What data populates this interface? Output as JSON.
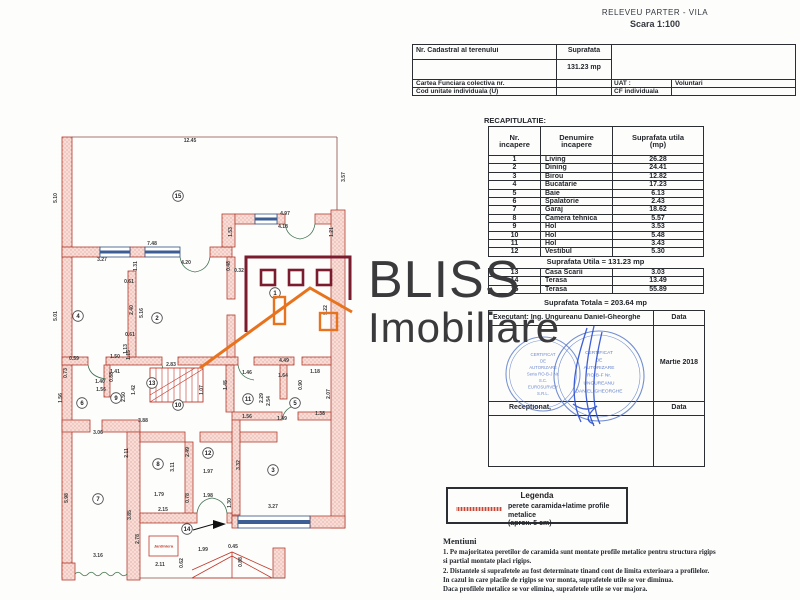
{
  "document": {
    "title": "RELEVEU PARTER - VILA",
    "scale": "Scara 1:100"
  },
  "cadastral": {
    "nr_cadastral_label": "Nr. Cadastral al terenului",
    "suprafata_label": "Suprafata",
    "suprafata_value": "131.23 mp",
    "carte_funciara_label": "Cartea Funciara colectiva nr.",
    "uat_label": "UAT :",
    "uat_value": "Voluntari",
    "cod_unitate_label": "Cod unitate individuala (U)",
    "cf_label": "CF individuala"
  },
  "recap": {
    "title": "RECAPITULATIE:",
    "headers": [
      "Nr.\nincapere",
      "Denumire\nincapere",
      "Suprafata utila\n(mp)"
    ],
    "rows": [
      [
        "1",
        "Living",
        "26.28"
      ],
      [
        "2",
        "Dining",
        "24.41"
      ],
      [
        "3",
        "Birou",
        "12.82"
      ],
      [
        "4",
        "Bucatarie",
        "17.23"
      ],
      [
        "5",
        "Baie",
        "6.13"
      ],
      [
        "6",
        "Spalatorie",
        "2.43"
      ],
      [
        "7",
        "Garaj",
        "18.62"
      ],
      [
        "8",
        "Camera tehnica",
        "5.57"
      ],
      [
        "9",
        "Hol",
        "3.53"
      ],
      [
        "10",
        "Hol",
        "5.48"
      ],
      [
        "11",
        "Hol",
        "3.43"
      ],
      [
        "12",
        "Vestibul",
        "5.30"
      ]
    ],
    "utila_line": "Suprafata Utila =  131.23 mp",
    "extra_rows": [
      [
        "13",
        "Casa Scarii",
        "3.03"
      ],
      [
        "14",
        "Terasa",
        "13.49"
      ],
      [
        "15",
        "Terasa",
        "55.89"
      ]
    ],
    "totala_line": "Suprafata Totala = 203.64 mp"
  },
  "execution": {
    "executant_label": "Executant: Ing. Ungureanu Daniel-Gheorghe",
    "data_label": "Data",
    "data_value": "Martie 2018",
    "receptionat_label": "Receptionat,",
    "data_label2": "Data",
    "stamp1": [
      "CERTIFICAT",
      "DE",
      "AUTORIZARE",
      "Seria RO-B-J Nr.",
      "S.C.",
      "EUROSURVEY",
      "S.R.L."
    ],
    "stamp2": [
      "CERTIFICAT",
      "DE",
      "AUTORIZARE",
      "RO-B-F Nr.",
      "UNGUREANU",
      "DANIEL-GHEORGHE"
    ]
  },
  "legend": {
    "title": "Legenda",
    "line1": "perete caramida+latime profile metalice",
    "line2": "(aprox. 5 cm)"
  },
  "mentiuni": {
    "title": "Mentiuni",
    "lines": [
      "1. Pe majoritatea peretilor de caramida sunt montate profile metalice pentru structura rigips",
      "si partial montate placi rigips.",
      "2. Distantele si suprafetele au fost determinate tinand cont de limita exterioara a profilelor.",
      "In cazul in care placile de rigips se vor monta, suprafetele utile se vor diminua.",
      "Daca profilele metalice se vor elimina, suprafetele utile se vor majora."
    ]
  },
  "watermark": {
    "line1": "BLISS",
    "line2": "Imobiliare"
  },
  "plan": {
    "jardiniera_label": "Jardiniera",
    "rooms": [
      {
        "n": "1",
        "x": 235,
        "y": 178
      },
      {
        "n": "2",
        "x": 117,
        "y": 203
      },
      {
        "n": "3",
        "x": 233,
        "y": 355
      },
      {
        "n": "4",
        "x": 38,
        "y": 201
      },
      {
        "n": "5",
        "x": 255,
        "y": 288
      },
      {
        "n": "6",
        "x": 42,
        "y": 288
      },
      {
        "n": "7",
        "x": 58,
        "y": 384
      },
      {
        "n": "8",
        "x": 118,
        "y": 349
      },
      {
        "n": "9",
        "x": 76,
        "y": 283
      },
      {
        "n": "10",
        "x": 138,
        "y": 290
      },
      {
        "n": "11",
        "x": 208,
        "y": 284
      },
      {
        "n": "12",
        "x": 168,
        "y": 338
      },
      {
        "n": "13",
        "x": 112,
        "y": 268
      },
      {
        "n": "14",
        "x": 147,
        "y": 414
      },
      {
        "n": "15",
        "x": 138,
        "y": 81
      }
    ],
    "dimensions": [
      {
        "t": "12.45",
        "x": 150,
        "y": 27,
        "r": 0
      },
      {
        "t": "5.10",
        "x": 17,
        "y": 83,
        "r": 1
      },
      {
        "t": "3.57",
        "x": 305,
        "y": 62,
        "r": 1
      },
      {
        "t": "4.97",
        "x": 245,
        "y": 100,
        "r": 0
      },
      {
        "t": "4.18",
        "x": 243,
        "y": 113,
        "r": 0
      },
      {
        "t": "1.53",
        "x": 192,
        "y": 117,
        "r": 1
      },
      {
        "t": "1.21",
        "x": 293,
        "y": 117,
        "r": 1
      },
      {
        "t": "7.48",
        "x": 112,
        "y": 130,
        "r": 0
      },
      {
        "t": "3.27",
        "x": 62,
        "y": 146,
        "r": 0
      },
      {
        "t": "4.20",
        "x": 146,
        "y": 149,
        "r": 0
      },
      {
        "t": "0.48",
        "x": 190,
        "y": 151,
        "r": 1
      },
      {
        "t": "0.32",
        "x": 199,
        "y": 157,
        "r": 0
      },
      {
        "t": "5.01",
        "x": 17,
        "y": 201,
        "r": 1
      },
      {
        "t": "0.61",
        "x": 89,
        "y": 168,
        "r": 0
      },
      {
        "t": "2.40",
        "x": 93,
        "y": 195,
        "r": 1
      },
      {
        "t": "5.16",
        "x": 103,
        "y": 198,
        "r": 1
      },
      {
        "t": "1.31",
        "x": 97,
        "y": 151,
        "r": 1
      },
      {
        "t": "5.22",
        "x": 287,
        "y": 195,
        "r": 1
      },
      {
        "t": "0.61",
        "x": 90,
        "y": 221,
        "r": 0
      },
      {
        "t": "1.13",
        "x": 87,
        "y": 234,
        "r": 1
      },
      {
        "t": "0.59",
        "x": 34,
        "y": 245,
        "r": 0
      },
      {
        "t": "0.73",
        "x": 27,
        "y": 258,
        "r": 1
      },
      {
        "t": "1.50",
        "x": 75,
        "y": 243,
        "r": 0
      },
      {
        "t": "1.41",
        "x": 75,
        "y": 258,
        "r": 0
      },
      {
        "t": "1.15",
        "x": 90,
        "y": 240,
        "r": 1
      },
      {
        "t": "1.40",
        "x": 60,
        "y": 268,
        "r": 0
      },
      {
        "t": "1.56",
        "x": 61,
        "y": 276,
        "r": 0
      },
      {
        "t": "0.88",
        "x": 73,
        "y": 262,
        "r": 1
      },
      {
        "t": "2.50",
        "x": 85,
        "y": 282,
        "r": 1
      },
      {
        "t": "1.42",
        "x": 95,
        "y": 275,
        "r": 1
      },
      {
        "t": "2.83",
        "x": 131,
        "y": 251,
        "r": 0
      },
      {
        "t": "1.07",
        "x": 163,
        "y": 275,
        "r": 1
      },
      {
        "t": "1.45",
        "x": 187,
        "y": 270,
        "r": 1
      },
      {
        "t": "1.46",
        "x": 207,
        "y": 259,
        "r": 0
      },
      {
        "t": "4.49",
        "x": 244,
        "y": 247,
        "r": 0
      },
      {
        "t": "1.64",
        "x": 243,
        "y": 262,
        "r": 0
      },
      {
        "t": "1.18",
        "x": 275,
        "y": 258,
        "r": 0
      },
      {
        "t": "0.90",
        "x": 262,
        "y": 270,
        "r": 1
      },
      {
        "t": "2.29",
        "x": 223,
        "y": 283,
        "r": 1
      },
      {
        "t": "2.54",
        "x": 230,
        "y": 286,
        "r": 1
      },
      {
        "t": "2.07",
        "x": 290,
        "y": 279,
        "r": 1
      },
      {
        "t": "1.56",
        "x": 207,
        "y": 303,
        "r": 0
      },
      {
        "t": "1.49",
        "x": 242,
        "y": 305,
        "r": 0
      },
      {
        "t": "1.38",
        "x": 280,
        "y": 300,
        "r": 0
      },
      {
        "t": "1.56",
        "x": 22,
        "y": 283,
        "r": 1
      },
      {
        "t": "3.88",
        "x": 103,
        "y": 307,
        "r": 0
      },
      {
        "t": "3.06",
        "x": 58,
        "y": 319,
        "r": 0
      },
      {
        "t": "2.11",
        "x": 88,
        "y": 338,
        "r": 1
      },
      {
        "t": "3.11",
        "x": 134,
        "y": 352,
        "r": 1
      },
      {
        "t": "2.49",
        "x": 149,
        "y": 337,
        "r": 1
      },
      {
        "t": "3.32",
        "x": 200,
        "y": 350,
        "r": 1
      },
      {
        "t": "1.97",
        "x": 168,
        "y": 358,
        "r": 0
      },
      {
        "t": "1.98",
        "x": 168,
        "y": 382,
        "r": 0
      },
      {
        "t": "0.78",
        "x": 149,
        "y": 383,
        "r": 1
      },
      {
        "t": "1.79",
        "x": 119,
        "y": 381,
        "r": 0
      },
      {
        "t": "2.15",
        "x": 123,
        "y": 396,
        "r": 0
      },
      {
        "t": "1.30",
        "x": 191,
        "y": 388,
        "r": 1
      },
      {
        "t": "3.27",
        "x": 233,
        "y": 393,
        "r": 0
      },
      {
        "t": "5.98",
        "x": 28,
        "y": 383,
        "r": 1
      },
      {
        "t": "3.85",
        "x": 91,
        "y": 400,
        "r": 1
      },
      {
        "t": "2.78",
        "x": 99,
        "y": 424,
        "r": 1
      },
      {
        "t": "3.16",
        "x": 58,
        "y": 442,
        "r": 0
      },
      {
        "t": "2.11",
        "x": 120,
        "y": 451,
        "r": 0
      },
      {
        "t": "0.62",
        "x": 143,
        "y": 448,
        "r": 1
      },
      {
        "t": "1.99",
        "x": 163,
        "y": 436,
        "r": 0
      },
      {
        "t": "0.45",
        "x": 193,
        "y": 433,
        "r": 0
      },
      {
        "t": "0.88",
        "x": 202,
        "y": 447,
        "r": 1
      }
    ]
  },
  "colors": {
    "wall_outline": "#b23b2e",
    "wall_fill": "#f8dcd6",
    "window_blue": "#3c5e94",
    "door_green": "#3f7050",
    "stamp_blue": "#4a6cc0",
    "logo_maroon": "#7b1c2e",
    "logo_orange": "#e8731f",
    "watermark_gray": "#3a3a3c",
    "legend_red": "#c4473a"
  }
}
